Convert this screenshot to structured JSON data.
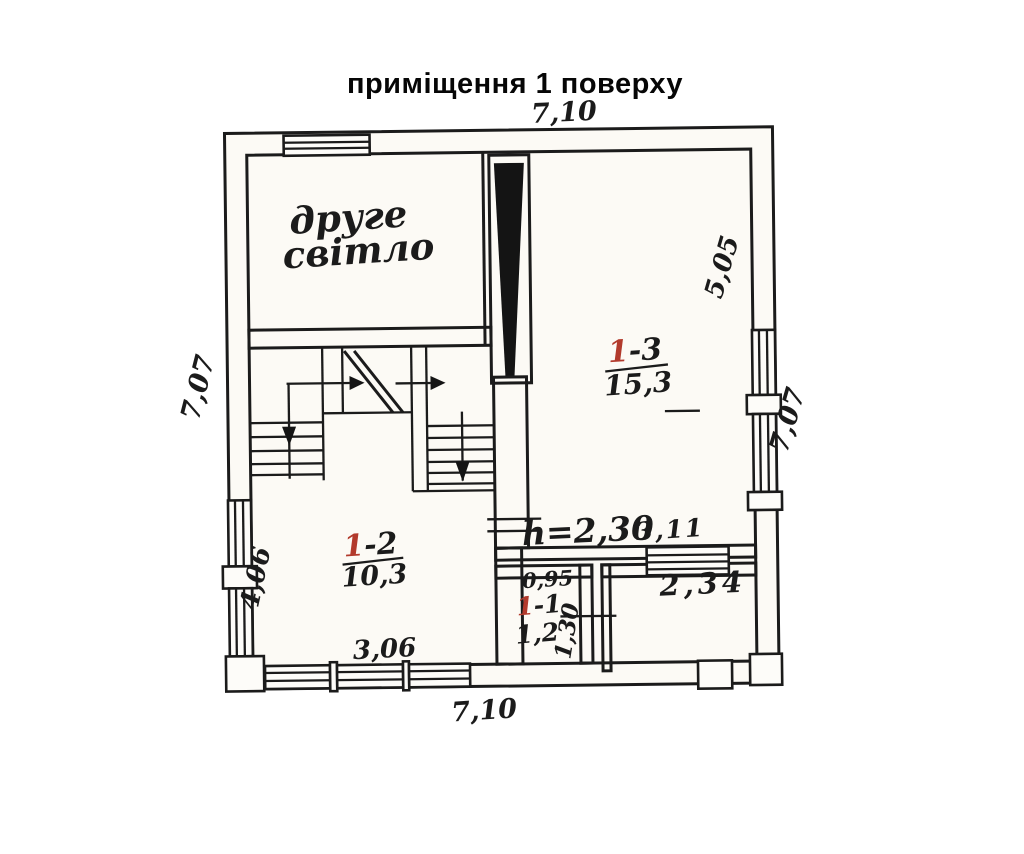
{
  "title": "приміщення 1 поверху",
  "colors": {
    "ink": "#1b1b1b",
    "accent_red": "#b23a2c",
    "paper": "#fcfaf5"
  },
  "labels": {
    "second_light_line1": "друге",
    "second_light_line2": "світло"
  },
  "rooms": {
    "r13": {
      "num": "1",
      "suf": "-3",
      "area": "15,3"
    },
    "r12": {
      "num": "1",
      "suf": "-2",
      "area": "10,3"
    },
    "r11": {
      "num": "1",
      "suf": "-1",
      "area": "1,2"
    }
  },
  "dims": {
    "top": "7,10",
    "bottom": "7,10",
    "left": "7,07",
    "right": "7,07",
    "inner_right": "5,05",
    "inner_left": "4,06",
    "room12_width": "3,06",
    "room13_width": "3,11",
    "ceiling_height": "h=2,30",
    "hall_width": "0,95",
    "hall_depth": "1,30",
    "porch_width": "2,34"
  }
}
